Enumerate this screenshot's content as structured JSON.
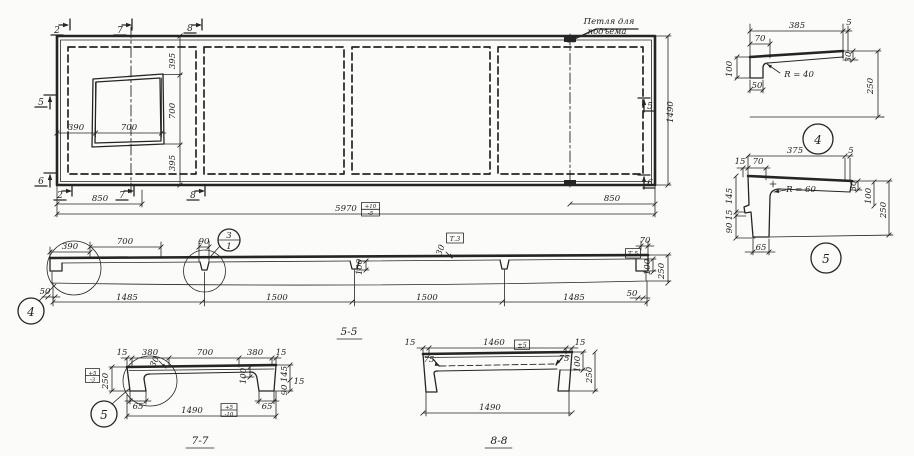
{
  "plan": {
    "markers": {
      "m2": "2",
      "m5": "5",
      "m6": "6",
      "m7": "7",
      "m8": "8"
    },
    "lifting_loop_label_1": "Петля для",
    "lifting_loop_label_2": "подъема",
    "dims": {
      "d390": "390",
      "d700": "700",
      "d395": "395",
      "d850": "850",
      "d5970": "5970",
      "d1490": "1490"
    },
    "tolerance_5970": {
      "plus": "+10",
      "minus": "-5"
    }
  },
  "section_5_5": {
    "title": "5-5",
    "dims": {
      "d390": "390",
      "d700": "700",
      "d90": "90",
      "d50": "50",
      "d1485": "1485",
      "d1500": "1500",
      "d100": "100",
      "d30": "30",
      "d70": "70",
      "d250": "250"
    },
    "boxes": {
      "t3": "Т.3",
      "t5": "Т.5"
    },
    "balloon": {
      "top": "3",
      "bottom": "1"
    },
    "callout_4": "4"
  },
  "detail_4": {
    "label": "4",
    "radius": "R = 40",
    "dims": {
      "d385": "385",
      "d5": "5",
      "d70": "70",
      "d100": "100",
      "d50": "50",
      "d30": "30",
      "d250": "250"
    }
  },
  "detail_5": {
    "label": "5",
    "radius": "R = 60",
    "dims": {
      "d375": "375",
      "d5": "5",
      "d15": "15",
      "d70": "70",
      "d145": "145",
      "d15b": "15",
      "d90": "90",
      "d65": "65",
      "d30": "30",
      "d100": "100",
      "d250": "250"
    }
  },
  "section_7_7": {
    "title": "7-7",
    "dims": {
      "d15": "15",
      "d380": "380",
      "d700": "700",
      "d30": "30",
      "d250": "250",
      "d100": "100",
      "d145": "145",
      "d15b": "15",
      "d90": "90",
      "d65": "65",
      "d1490": "1490"
    },
    "tol_250": {
      "plus": "+5",
      "minus": "-3"
    },
    "tol_1490": {
      "plus": "+5",
      "minus": "-10"
    },
    "callout_5": "5"
  },
  "section_8_8": {
    "title": "8-8",
    "dims": {
      "d15": "15",
      "d1460": "1460",
      "d75": "75",
      "d100": "100",
      "d250": "250",
      "d1490": "1490"
    },
    "tol_1460": "±5"
  }
}
